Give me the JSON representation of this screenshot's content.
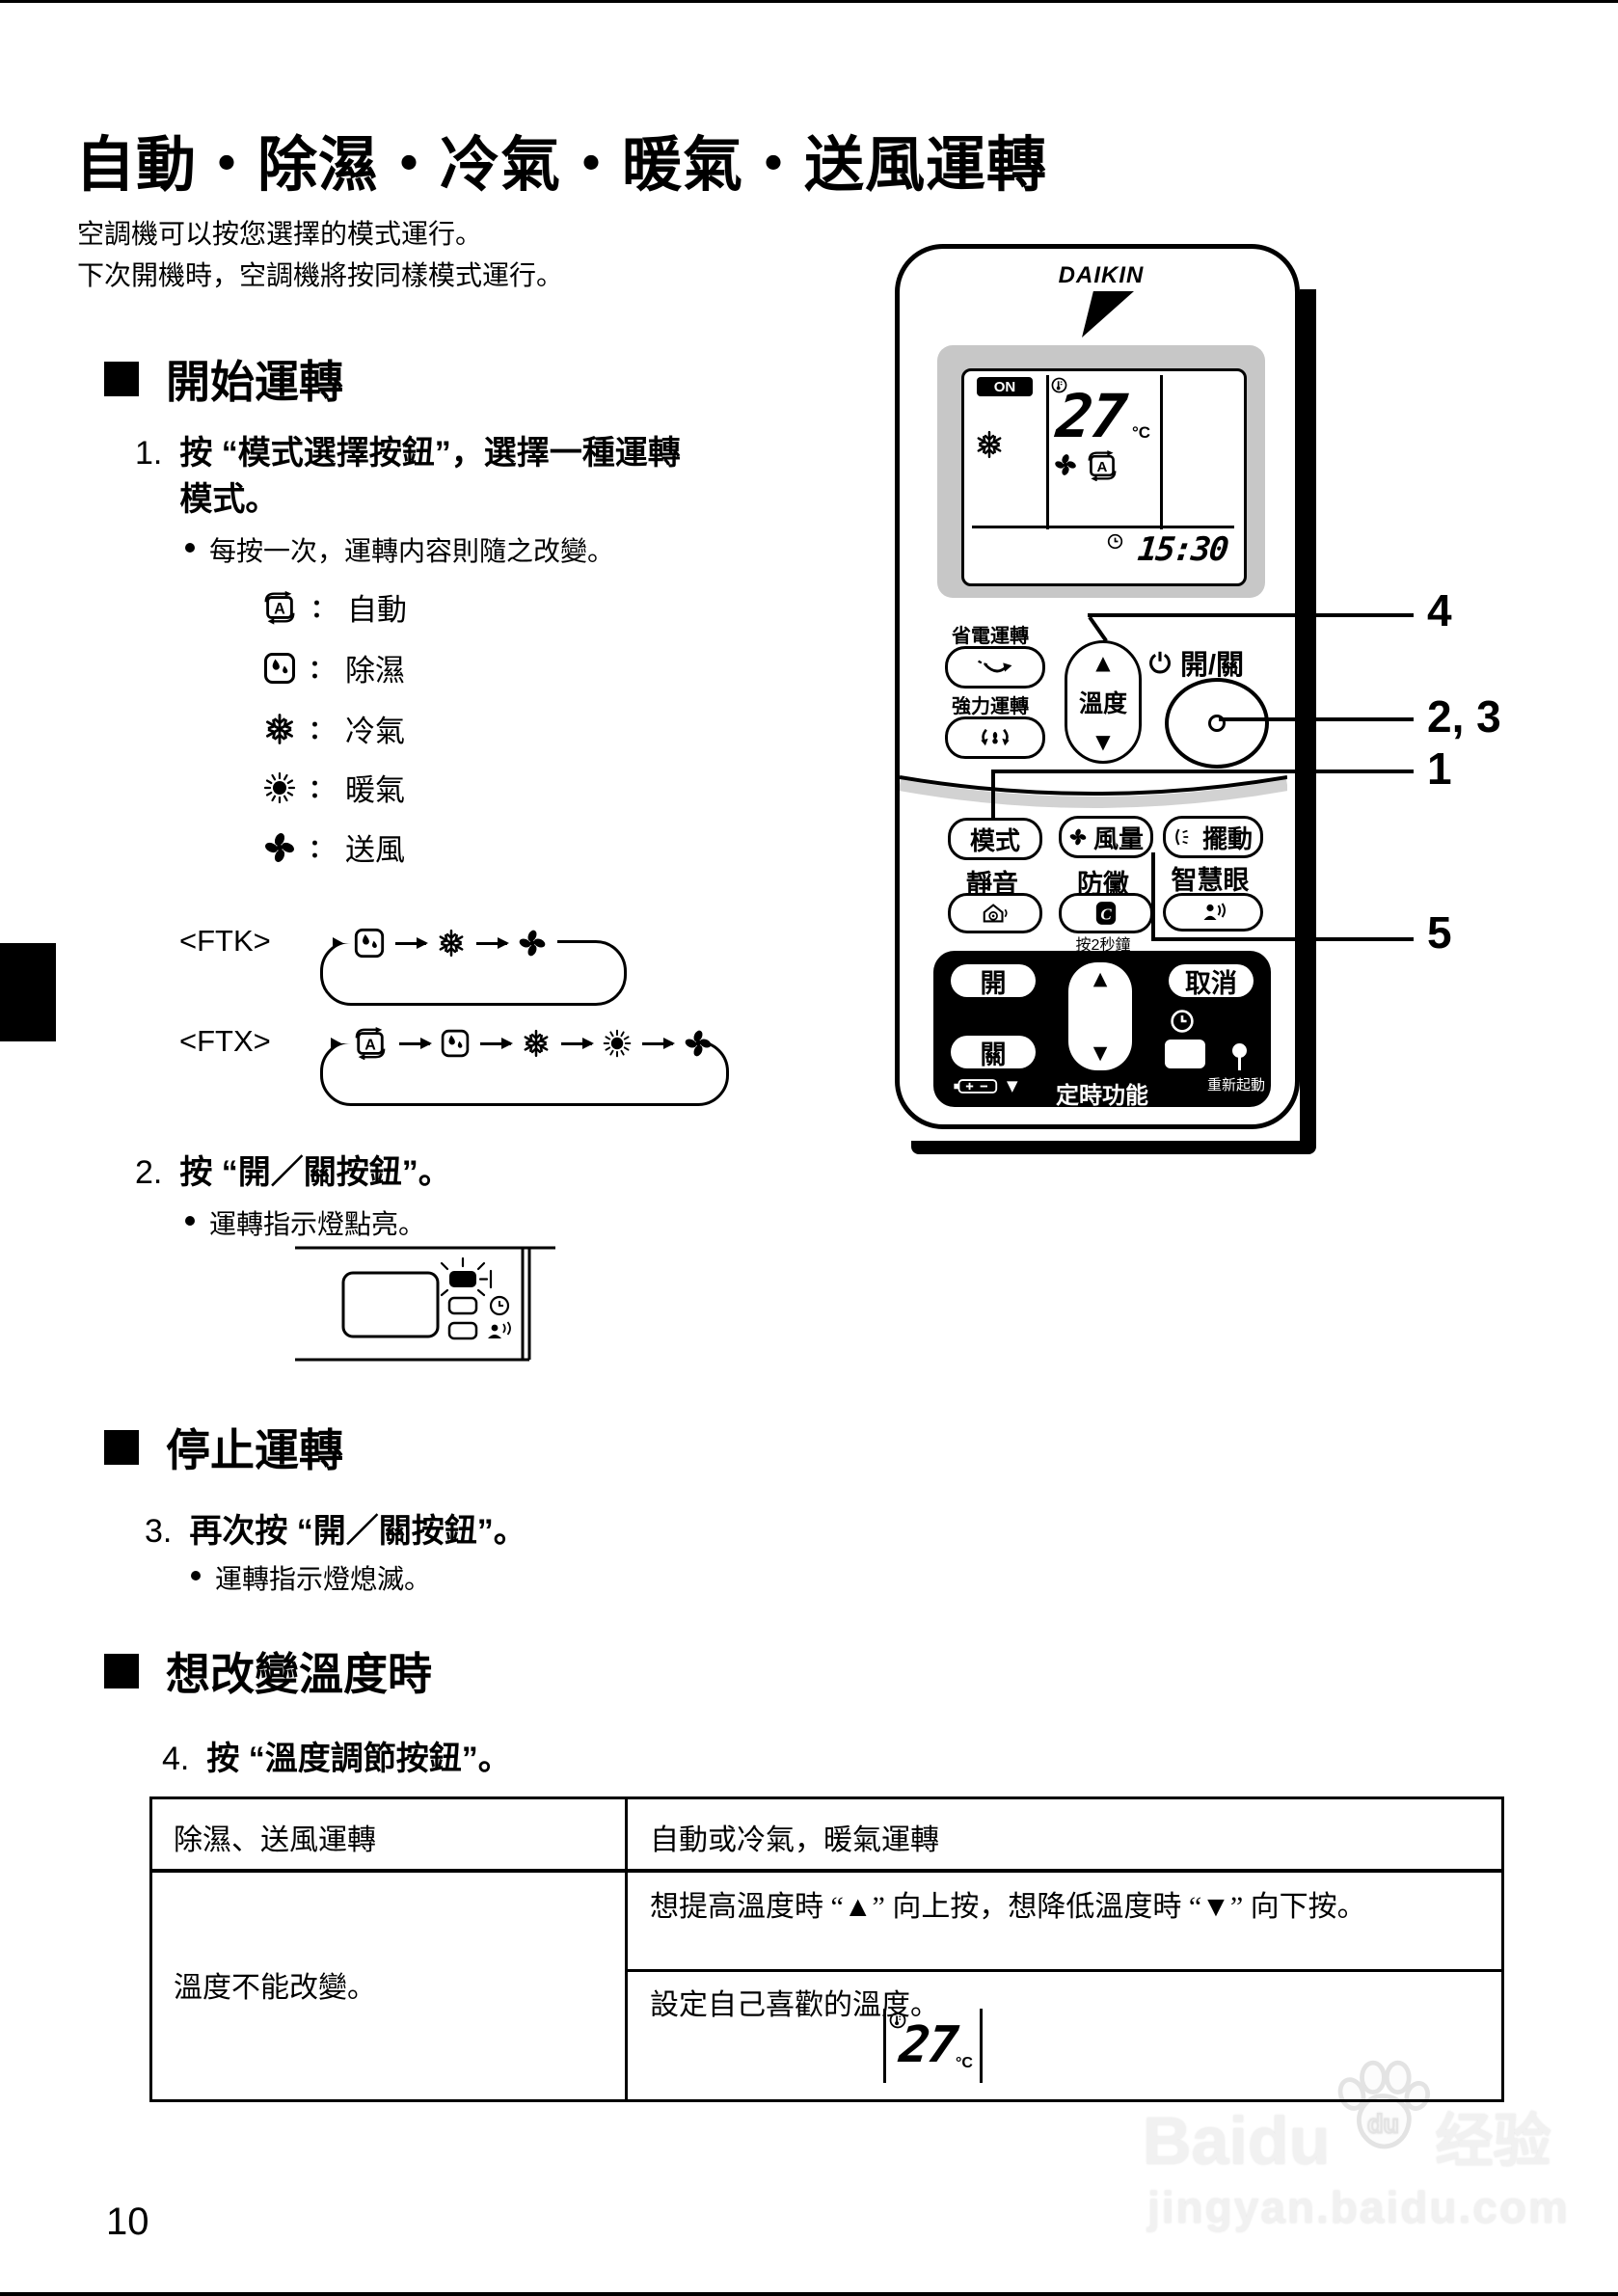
{
  "title": "自動・除濕・冷氣・暖氣・送風運轉",
  "intro": {
    "line1": "空調機可以按您選擇的模式運行。",
    "line2": "下次開機時，空調機將按同樣模式運行。"
  },
  "sections": {
    "start_heading": "開始運轉",
    "stop_heading": "停止運轉",
    "temp_heading": "想改變溫度時"
  },
  "steps": {
    "s1_num": "1.",
    "s1_line1": "按 “模式選擇按鈕”，選擇一種運轉",
    "s1_line2": "模式。",
    "s1_bullet": "每按一次，運轉内容則隨之改變。",
    "s2_num": "2.",
    "s2_text": "按 “開／關按鈕”。",
    "s2_bullet": "運轉指示燈點亮。",
    "s3_num": "3.",
    "s3_text": "再次按 “開／關按鈕”。",
    "s3_bullet": "運轉指示燈熄滅。",
    "s4_num": "4.",
    "s4_text": "按 “溫度調節按鈕”。"
  },
  "modes": [
    {
      "colon": "：",
      "label": "自動"
    },
    {
      "colon": "：",
      "label": "除濕"
    },
    {
      "colon": "：",
      "label": "冷氣"
    },
    {
      "colon": "：",
      "label": "暖氣"
    },
    {
      "colon": "：",
      "label": "送風"
    }
  ],
  "cycles": {
    "ftk_label": "<FTK>",
    "ftx_label": "<FTX>"
  },
  "remote": {
    "brand": "DAIKIN",
    "display": {
      "on_badge": "ON",
      "temp": "27",
      "temp_unit": "°C",
      "time": "15:30"
    },
    "buttons": {
      "powersave": "省電運轉",
      "powerful": "強力運轉",
      "temp": "溫度",
      "power": "開/關",
      "mode": "模式",
      "fan_speed": "風量",
      "swing": "擺動",
      "quiet": "靜音",
      "mold": "防黴",
      "smart_eye": "智慧眼",
      "hold_hint": "按2秒鐘",
      "timer_on": "開",
      "timer_off": "關",
      "cancel": "取消",
      "timer_label": "定時功能",
      "restart": "重新起動",
      "up_glyph": "▲",
      "down_glyph": "▼"
    }
  },
  "callouts": {
    "n4": "4",
    "n23": "2, 3",
    "n1": "1",
    "n5": "5"
  },
  "table": {
    "header_left": "除濕、送風運轉",
    "header_right": "自動或冷氣，暖氣運轉",
    "merged_left": "溫度不能改變。",
    "row2_right": "想提高溫度時 “▲” 向上按，想降低溫度時 “▼” 向下按。",
    "row3_right": "設定自己喜歡的溫度。",
    "display_temp": "27",
    "display_unit": "°C"
  },
  "footer": {
    "page_number": "10"
  },
  "watermark": {
    "brand": "Baidu",
    "suffix": "经验",
    "url": "jingyan.baidu.com"
  }
}
